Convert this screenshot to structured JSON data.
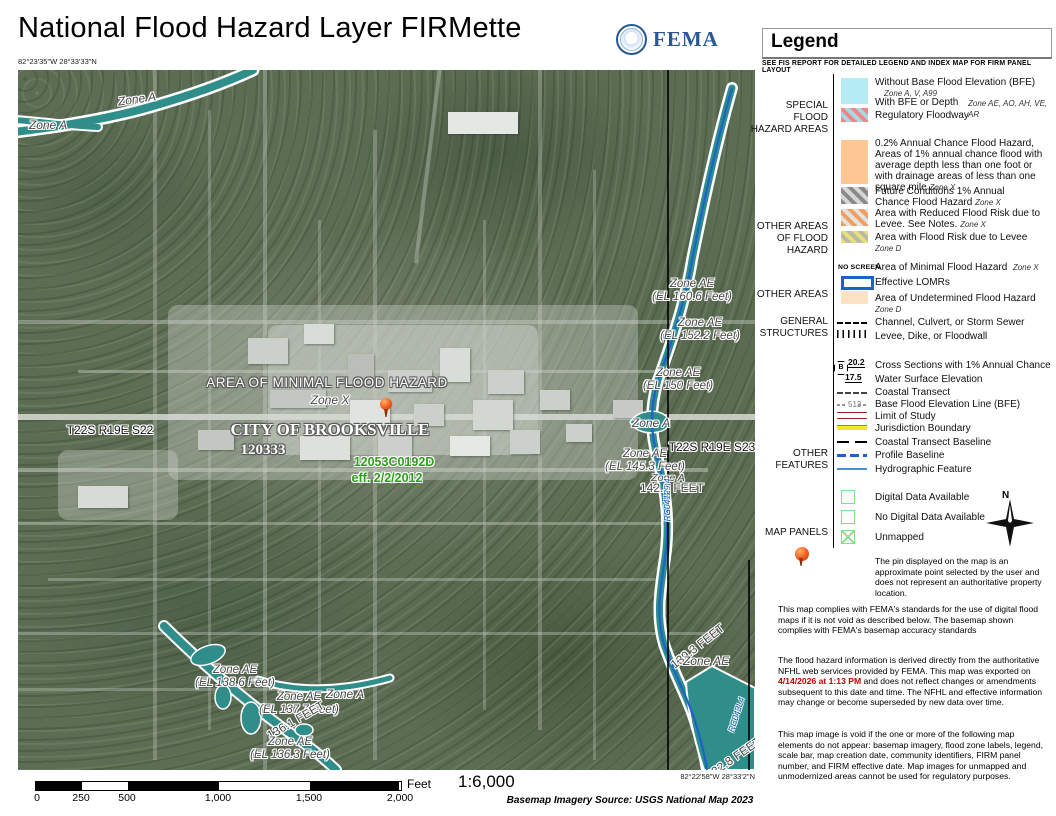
{
  "header": {
    "title": "National Flood Hazard Layer FIRMette",
    "fema_word": "FEMA"
  },
  "map": {
    "corner_tl": "82°23'35\"W 28°33'33\"N",
    "corner_br": "82°22'58\"W 28°33'2\"N",
    "labels": {
      "zone_a_1": "Zone A",
      "zone_a_2": "Zone A",
      "minimal": "AREA OF MINIMAL FLOOD HAZARD",
      "zone_x": "Zone X",
      "city": "CITY OF BROOKSVILLE",
      "community_id": "120333",
      "panel_id": "12053C0192D",
      "effective": "eff. 2/2/2012",
      "section_22": "T22S R19E S22",
      "section_23": "T22S R19E S23",
      "ae_160": {
        "z": "Zone AE",
        "el": "(EL 160.6 Feet)"
      },
      "ae_152": {
        "z": "Zone AE",
        "el": "(EL 152.2 Feet)"
      },
      "ae_150": {
        "z": "Zone AE",
        "el": "(EL 150 Feet)"
      },
      "zone_a_3": "Zone A",
      "ae_145": {
        "z": "Zone AE",
        "el": "(EL 145.3 Feet)"
      },
      "zone_a_4": "Zone A",
      "feet_142": "142.2 FEET",
      "rc_upper": "RC04129.4",
      "feet_139": "139.3 FEET",
      "ae_lower": "Zone AE",
      "rc_lower": "RC043L4",
      "feet_132": "132.8 FEET",
      "ae_138": {
        "z": "Zone AE",
        "el": "(EL 138.6 Feet)"
      },
      "ae_137": {
        "z": "Zone AE",
        "el": "(EL 137.7 Feet)"
      },
      "zone_a_5": "Zone A",
      "feet_136": "136.1 FEET",
      "ae_136": {
        "z": "Zone AE",
        "el": "(EL 136.3 Feet)"
      }
    }
  },
  "legend": {
    "title": "Legend",
    "subtitle": "SEE FIS REPORT FOR DETAILED LEGEND AND INDEX MAP FOR FIRM PANEL LAYOUT",
    "sfha": {
      "label": "SPECIAL FLOOD HAZARD AREAS",
      "without_bfe": "Without Base Flood Elevation (BFE)",
      "without_bfe_zones": "Zone A, V, A99",
      "with_bfe": "With BFE or Depth",
      "with_bfe_zones": "Zone AE, AO, AH, VE, AR",
      "floodway": "Regulatory Floodway"
    },
    "other_flood": {
      "label": "OTHER AREAS OF FLOOD HAZARD",
      "pct02": "0.2% Annual Chance Flood Hazard, Areas of 1% annual chance flood with average depth less than one foot or with drainage areas of less than one square mile",
      "pct02_zone": "Zone X",
      "future": "Future Conditions 1% Annual Chance Flood Hazard",
      "future_zone": "Zone X",
      "reduced": "Area with Reduced Flood Risk due to Levee. See Notes.",
      "reduced_zone": "Zone X",
      "levee_risk": "Area with Flood Risk due to Levee",
      "levee_risk_zone": "Zone D"
    },
    "other_areas": {
      "label": "OTHER AREAS",
      "no_screen": "NO SCREEN",
      "minimal": "Area of Minimal Flood Hazard",
      "minimal_zone": "Zone X",
      "lomr": "Effective LOMRs",
      "undetermined": "Area of Undetermined Flood Hazard",
      "undetermined_zone": "Zone D"
    },
    "structures": {
      "label": "GENERAL STRUCTURES",
      "channel": "Channel, Culvert, or Storm Sewer",
      "levee": "Levee, Dike, or Floodwall"
    },
    "features": {
      "label": "OTHER FEATURES",
      "cross_b": "B",
      "cross_val": "20.2",
      "cross": "Cross Sections with 1% Annual Chance",
      "wse_val": "17.5",
      "wse": "Water Surface Elevation",
      "coastal": "Coastal Transect",
      "bfe_val": "513",
      "bfe": "Base Flood Elevation Line (BFE)",
      "limit": "Limit of Study",
      "jurisdiction": "Jurisdiction Boundary",
      "baseline": "Coastal Transect Baseline",
      "profile": "Profile Baseline",
      "hydro": "Hydrographic Feature"
    },
    "panels": {
      "label": "MAP PANELS",
      "digital": "Digital Data Available",
      "no_digital": "No Digital Data Available",
      "unmapped": "Unmapped",
      "north": "N"
    },
    "pin_note": "The pin displayed on the map is an approximate point selected by the user and does not represent an authoritative property location.",
    "notes": {
      "p1": "This map complies with FEMA's standards for the use of digital flood maps if it is not void as described below. The basemap shown complies with FEMA's basemap accuracy standards",
      "p2a": "The flood hazard information is derived directly from the authoritative NFHL web services provided by FEMA. This map was exported on ",
      "p2_date": "4/14/2026 at 1:13 PM",
      "p2b": " and does not reflect changes or amendments subsequent to this date and time. The NFHL and effective information may change or become superseded by new data over time.",
      "p3": "This map image is void if the one or more of the following map elements do not appear: basemap imagery, flood zone labels, legend, scale bar, map creation date, community identifiers, FIRM panel number, and FIRM effective date. Map images for unmapped and unmodernized areas cannot be used for regulatory purposes."
    }
  },
  "scalebar": {
    "ticks": [
      "0",
      "250",
      "500",
      "1,000",
      "1,500",
      "2,000"
    ],
    "unit": "Feet",
    "ratio": "1:6,000",
    "source": "Basemap Imagery Source: USGS National Map 2023"
  },
  "colors": {
    "sfha_cyan": "#b5ecf4",
    "flood_02pct_orange": "#fcc792",
    "undetermined_orange": "#fce3c4",
    "stream_teal": "#2f8e8a",
    "profile_blue": "#1d62c8",
    "limit_red": "#9e1b1b",
    "jurisdiction_yellow": "#f0e62e",
    "panel_box_green": "#86de86",
    "effective_green": "#2f9e1e",
    "export_date_red": "#c00000",
    "fema_blue": "#2b5797"
  }
}
